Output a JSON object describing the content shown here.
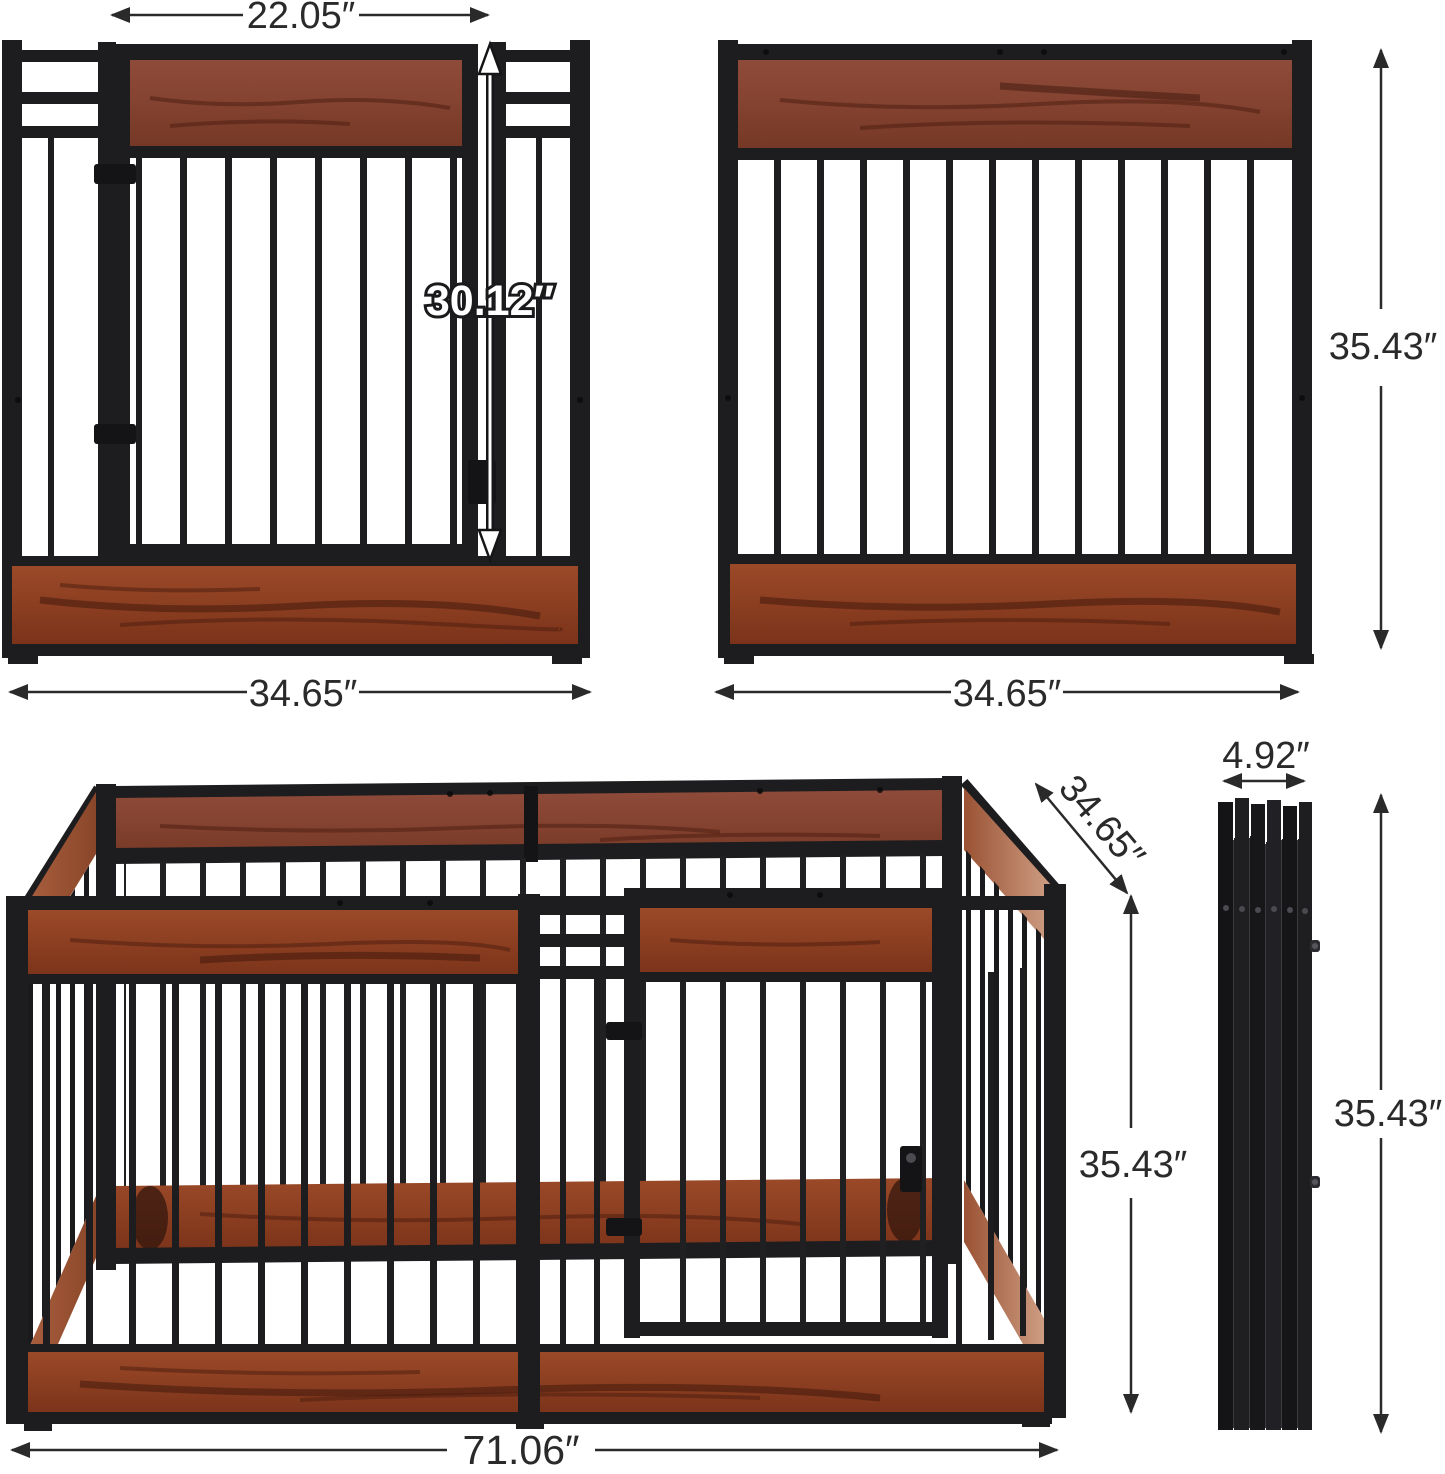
{
  "colors": {
    "metal_frame": "#1d1d20",
    "wood_plank": "#8e4326",
    "wood_plank_dark": "#5a2514",
    "wood_side_light": "#b06a48",
    "dimension_text": "#2a2a2a",
    "door_height_text_fill": "#ffffff",
    "background": "#ffffff"
  },
  "views": {
    "door_panel": {
      "door_width_label": "22.05″",
      "door_height_label": "30.12″",
      "panel_width_label": "34.65″"
    },
    "plain_panel": {
      "panel_width_label": "34.65″",
      "panel_height_label": "35.43″"
    },
    "assembled": {
      "length_label": "71.06″",
      "depth_label": "34.65″",
      "height_label": "35.43″"
    },
    "folded": {
      "thickness_label": "4.92″",
      "height_label": "35.43″"
    }
  }
}
